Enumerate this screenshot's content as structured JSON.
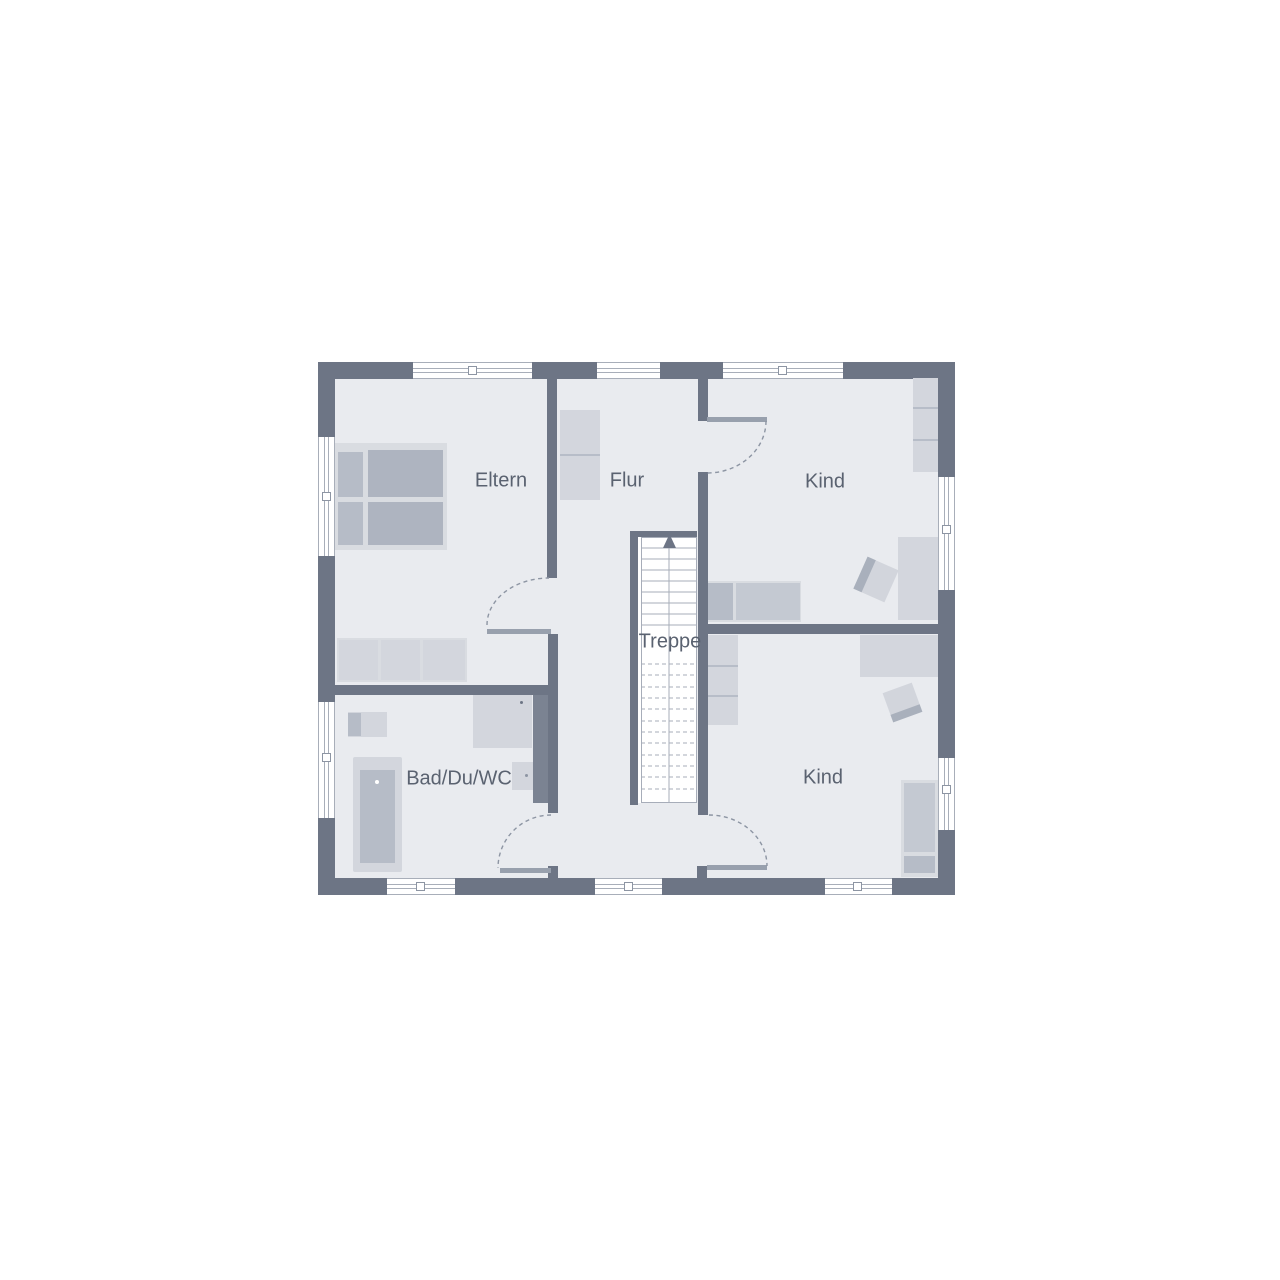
{
  "title": "Obergeschoss Grundriss",
  "rooms": [
    {
      "name": "eltern",
      "label": "Eltern"
    },
    {
      "name": "flur",
      "label": "Flur"
    },
    {
      "name": "kind_top",
      "label": "Kind"
    },
    {
      "name": "treppe",
      "label": "Treppe"
    },
    {
      "name": "bad",
      "label": "Bad/Du/WC"
    },
    {
      "name": "kind_bottom",
      "label": "Kind"
    }
  ],
  "stairs": {
    "direction": "up",
    "arrow_icon": "arrow-up-icon"
  },
  "furniture": [
    "double-bed",
    "wardrobe",
    "hall-closet",
    "single-bed",
    "desk",
    "desk-chair",
    "shelf",
    "bathtub",
    "washbasin",
    "shower",
    "toilet"
  ],
  "colors": {
    "wall": "#6d7585",
    "floor": "#e9ebef",
    "furniture_light": "#d3d6dd",
    "furniture_medium": "#c4c9d2",
    "furniture_dark": "#aeb4c0",
    "stair_line": "#a7adb9",
    "door_arc": "#8d95a3",
    "label_text": "#5a6270",
    "background": "#ffffff"
  }
}
